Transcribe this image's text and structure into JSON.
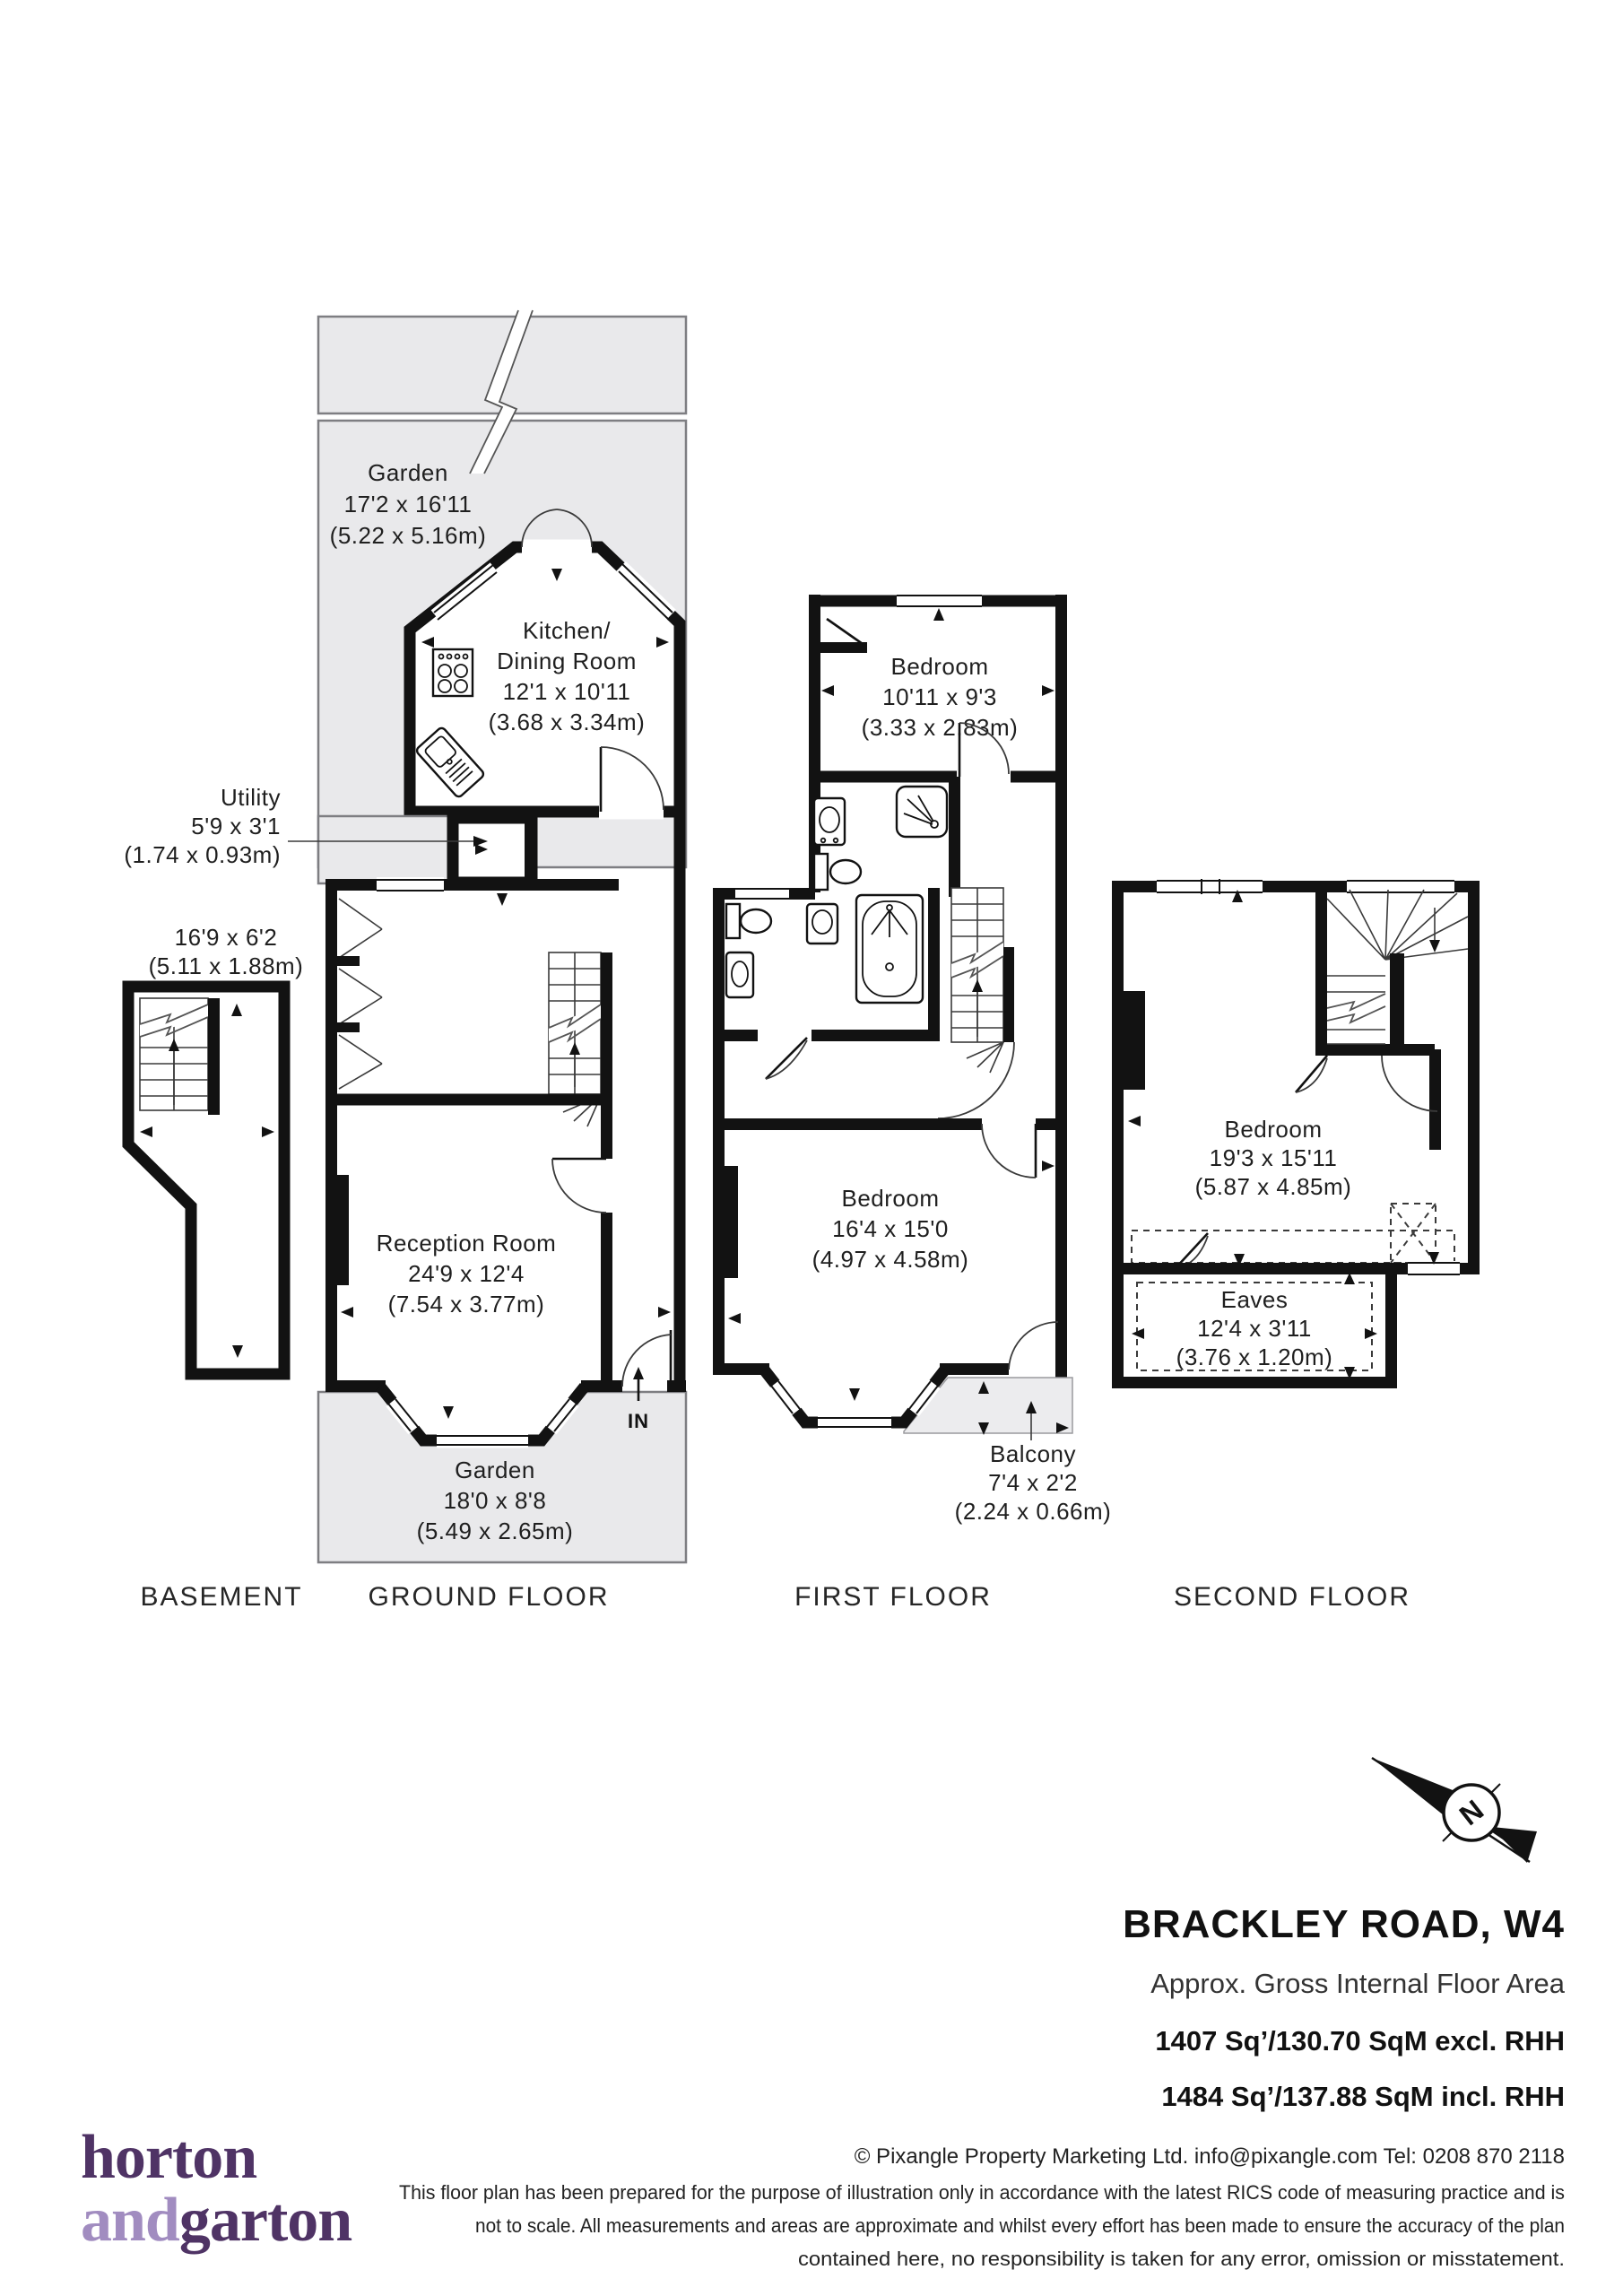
{
  "plan": {
    "garden_top": {
      "name": "Garden",
      "dims_ft": "17'2 x 16'11",
      "dims_m": "(5.22 x 5.16m)"
    },
    "kitchen": {
      "name_line1": "Kitchen/",
      "name_line2": "Dining Room",
      "dims_ft": "12'1 x 10'11",
      "dims_m": "(3.68 x 3.34m)"
    },
    "utility": {
      "name": "Utility",
      "dims_ft": "5'9 x 3'1",
      "dims_m": "(1.74 x 0.93m)"
    },
    "basement_room": {
      "dims_ft": "16'9 x 6'2",
      "dims_m": "(5.11 x 1.88m)"
    },
    "reception": {
      "name": "Reception Room",
      "dims_ft": "24'9 x 12'4",
      "dims_m": "(7.54 x 3.77m)"
    },
    "garden_bottom": {
      "name": "Garden",
      "dims_ft": "18'0 x 8'8",
      "dims_m": "(5.49 x 2.65m)"
    },
    "bedroom_first_rear": {
      "name": "Bedroom",
      "dims_ft": "10'11 x 9'3",
      "dims_m": "(3.33 x 2.83m)"
    },
    "bedroom_first_front": {
      "name": "Bedroom",
      "dims_ft": "16'4 x 15'0",
      "dims_m": "(4.97 x 4.58m)"
    },
    "balcony": {
      "name": "Balcony",
      "dims_ft": "7'4 x 2'2",
      "dims_m": "(2.24 x 0.66m)"
    },
    "bedroom_second": {
      "name": "Bedroom",
      "dims_ft": "19'3 x 15'11",
      "dims_m": "(5.87 x 4.85m)"
    },
    "eaves": {
      "name": "Eaves",
      "dims_ft": "12'4 x 3'11",
      "dims_m": "(3.76 x 1.20m)"
    },
    "entrance": "IN",
    "compass": "N",
    "floor_labels": {
      "basement": "BASEMENT",
      "ground": "GROUND FLOOR",
      "first": "FIRST FLOOR",
      "second": "SECOND FLOOR"
    }
  },
  "title_block": {
    "address": "BRACKLEY ROAD, W4",
    "area_heading": "Approx. Gross Internal Floor Area",
    "area_excl": "1407 Sq’/130.70 SqM excl. RHH",
    "area_incl": "1484 Sq’/137.88 SqM incl. RHH"
  },
  "footer": {
    "credit": "© Pixangle Property Marketing Ltd. info@pixangle.com Tel: 0208 870 2118",
    "disclaimer_line1": "This floor plan has been prepared for the purpose of illustration only in accordance with the latest RICS code of measuring practice and is",
    "disclaimer_line2": "not to scale. All measurements and areas are approximate and whilst every effort has been made to ensure the accuracy of the plan",
    "disclaimer_line3": "contained here, no responsibility is taken for any error, omission or misstatement.",
    "logo_line1": "horton",
    "logo_line2_light": "and",
    "logo_line2_dark": "garton"
  },
  "colors": {
    "wall": "#121212",
    "garden_fill": "#e9e9eb",
    "balcony_fill": "#ececee",
    "logo_dark": "#4f3365",
    "logo_light": "#a18cc0"
  }
}
